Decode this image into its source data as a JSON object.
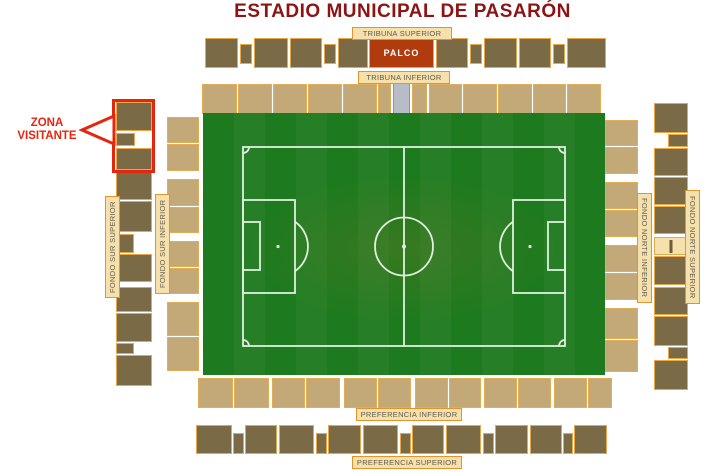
{
  "title": "ESTADIO MUNICIPAL DE PASARÓN",
  "callout": {
    "line1": "ZONA",
    "line2": "VISITANTE"
  },
  "labels": {
    "tribuna_superior": "TRIBUNA SUPERIOR",
    "tribuna_inferior": "TRIBUNA INFERIOR",
    "preferencia_inferior": "PREFERENCIA INFERIOR",
    "preferencia_superior": "PREFERENCIA SUPERIOR",
    "fondo_sur_superior": "FONDO SUR SUPERIOR",
    "fondo_sur_inferior": "FONDO SUR INFERIOR",
    "fondo_norte_inferior": "FONDO NORTE INFERIOR",
    "fondo_norte_superior": "FONDO NORTE SUPERIOR"
  },
  "colors": {
    "title": "#8d1414",
    "callout_red": "#e6250f",
    "dark_block": "#7a6a45",
    "block_border": "#eaa74a",
    "tan_block": "#c3a977",
    "tan_border": "#e3ad58",
    "label_bg": "#f6e0ac",
    "label_border": "#e2952d",
    "label_text": "#5f5b4e",
    "palco_bg": "#b03b0d",
    "palco_text": "#ffffff",
    "vip_gray": "#b7bcc7",
    "vip_gray_border": "#8a97ac",
    "pitch_green_a": "#1e7a1e",
    "pitch_green_b": "#267f26",
    "pitch_line": "#dff0df"
  },
  "stands": [
    {
      "name": "tribuna-superior",
      "kind": "dark",
      "blocks": [
        {
          "x": 205,
          "y": 38,
          "w": 33,
          "h": 30
        },
        {
          "x": 240,
          "y": 44,
          "w": 12,
          "h": 20
        },
        {
          "x": 254,
          "y": 38,
          "w": 34,
          "h": 30
        },
        {
          "x": 290,
          "y": 38,
          "w": 32,
          "h": 30
        },
        {
          "x": 324,
          "y": 44,
          "w": 12,
          "h": 20
        },
        {
          "x": 338,
          "y": 38,
          "w": 30,
          "h": 30
        },
        {
          "x": 369,
          "y": 38,
          "w": 65,
          "h": 30,
          "kind": "palco",
          "label": "PALCO"
        },
        {
          "x": 436,
          "y": 38,
          "w": 32,
          "h": 30
        },
        {
          "x": 470,
          "y": 44,
          "w": 12,
          "h": 20
        },
        {
          "x": 484,
          "y": 38,
          "w": 33,
          "h": 30
        },
        {
          "x": 519,
          "y": 38,
          "w": 32,
          "h": 30
        },
        {
          "x": 553,
          "y": 44,
          "w": 12,
          "h": 20
        },
        {
          "x": 567,
          "y": 38,
          "w": 39,
          "h": 30
        }
      ]
    },
    {
      "name": "tribuna-inferior",
      "kind": "tan",
      "blocks": [
        {
          "x": 202,
          "y": 84,
          "w": 35,
          "h": 30
        },
        {
          "x": 238,
          "y": 84,
          "w": 34,
          "h": 30
        },
        {
          "x": 273,
          "y": 84,
          "w": 34,
          "h": 30
        },
        {
          "x": 308,
          "y": 84,
          "w": 34,
          "h": 30
        },
        {
          "x": 343,
          "y": 84,
          "w": 34,
          "h": 30
        },
        {
          "x": 378,
          "y": 84,
          "w": 13,
          "h": 30
        },
        {
          "x": 393,
          "y": 83,
          "w": 17,
          "h": 31,
          "kind": "gray"
        },
        {
          "x": 412,
          "y": 84,
          "w": 15,
          "h": 30
        },
        {
          "x": 429,
          "y": 84,
          "w": 33,
          "h": 30
        },
        {
          "x": 463,
          "y": 84,
          "w": 34,
          "h": 30
        },
        {
          "x": 498,
          "y": 84,
          "w": 34,
          "h": 30
        },
        {
          "x": 533,
          "y": 84,
          "w": 33,
          "h": 30
        },
        {
          "x": 567,
          "y": 84,
          "w": 34,
          "h": 30
        }
      ]
    },
    {
      "name": "preferencia-inferior",
      "kind": "tan",
      "blocks": [
        {
          "x": 198,
          "y": 378,
          "w": 35,
          "h": 30
        },
        {
          "x": 234,
          "y": 378,
          "w": 35,
          "h": 30
        },
        {
          "x": 272,
          "y": 378,
          "w": 33,
          "h": 30
        },
        {
          "x": 306,
          "y": 378,
          "w": 34,
          "h": 30
        },
        {
          "x": 344,
          "y": 378,
          "w": 33,
          "h": 30
        },
        {
          "x": 378,
          "y": 378,
          "w": 33,
          "h": 30
        },
        {
          "x": 415,
          "y": 378,
          "w": 33,
          "h": 30
        },
        {
          "x": 449,
          "y": 378,
          "w": 32,
          "h": 30
        },
        {
          "x": 484,
          "y": 378,
          "w": 33,
          "h": 30
        },
        {
          "x": 518,
          "y": 378,
          "w": 33,
          "h": 30
        },
        {
          "x": 554,
          "y": 378,
          "w": 33,
          "h": 30
        },
        {
          "x": 588,
          "y": 378,
          "w": 24,
          "h": 30
        }
      ]
    },
    {
      "name": "preferencia-superior",
      "kind": "dark",
      "blocks": [
        {
          "x": 196,
          "y": 425,
          "w": 36,
          "h": 29
        },
        {
          "x": 233,
          "y": 433,
          "w": 11,
          "h": 21
        },
        {
          "x": 245,
          "y": 425,
          "w": 32,
          "h": 29
        },
        {
          "x": 279,
          "y": 425,
          "w": 35,
          "h": 29
        },
        {
          "x": 316,
          "y": 433,
          "w": 11,
          "h": 21
        },
        {
          "x": 328,
          "y": 425,
          "w": 33,
          "h": 29
        },
        {
          "x": 363,
          "y": 425,
          "w": 35,
          "h": 29
        },
        {
          "x": 400,
          "y": 433,
          "w": 11,
          "h": 21
        },
        {
          "x": 412,
          "y": 425,
          "w": 32,
          "h": 29
        },
        {
          "x": 446,
          "y": 425,
          "w": 35,
          "h": 29
        },
        {
          "x": 483,
          "y": 433,
          "w": 11,
          "h": 21
        },
        {
          "x": 495,
          "y": 425,
          "w": 33,
          "h": 29
        },
        {
          "x": 530,
          "y": 425,
          "w": 32,
          "h": 29
        },
        {
          "x": 563,
          "y": 433,
          "w": 10,
          "h": 21
        },
        {
          "x": 574,
          "y": 425,
          "w": 33,
          "h": 29
        }
      ]
    },
    {
      "name": "fondo-sur-superior",
      "kind": "dark",
      "blocks": [
        {
          "x": 116,
          "y": 102,
          "w": 36,
          "h": 29
        },
        {
          "x": 116,
          "y": 133,
          "w": 19,
          "h": 13
        },
        {
          "x": 116,
          "y": 148,
          "w": 36,
          "h": 22
        },
        {
          "x": 116,
          "y": 172,
          "w": 36,
          "h": 28
        },
        {
          "x": 116,
          "y": 201,
          "w": 36,
          "h": 31
        },
        {
          "x": 116,
          "y": 234,
          "w": 18,
          "h": 19
        },
        {
          "x": 116,
          "y": 254,
          "w": 36,
          "h": 28
        },
        {
          "x": 116,
          "y": 287,
          "w": 36,
          "h": 25
        },
        {
          "x": 116,
          "y": 313,
          "w": 36,
          "h": 29
        },
        {
          "x": 116,
          "y": 343,
          "w": 18,
          "h": 11
        },
        {
          "x": 116,
          "y": 355,
          "w": 36,
          "h": 31
        }
      ]
    },
    {
      "name": "fondo-sur-inferior",
      "kind": "tan",
      "blocks": [
        {
          "x": 167,
          "y": 117,
          "w": 32,
          "h": 26
        },
        {
          "x": 167,
          "y": 144,
          "w": 32,
          "h": 27
        },
        {
          "x": 167,
          "y": 179,
          "w": 32,
          "h": 27
        },
        {
          "x": 167,
          "y": 207,
          "w": 32,
          "h": 26
        },
        {
          "x": 167,
          "y": 241,
          "w": 32,
          "h": 26
        },
        {
          "x": 167,
          "y": 268,
          "w": 32,
          "h": 26
        },
        {
          "x": 167,
          "y": 302,
          "w": 32,
          "h": 34
        },
        {
          "x": 167,
          "y": 337,
          "w": 32,
          "h": 34
        }
      ]
    },
    {
      "name": "fondo-norte-inferior",
      "kind": "tan",
      "blocks": [
        {
          "x": 605,
          "y": 120,
          "w": 33,
          "h": 26
        },
        {
          "x": 605,
          "y": 147,
          "w": 33,
          "h": 27
        },
        {
          "x": 605,
          "y": 182,
          "w": 33,
          "h": 27
        },
        {
          "x": 605,
          "y": 210,
          "w": 33,
          "h": 27
        },
        {
          "x": 605,
          "y": 245,
          "w": 33,
          "h": 27
        },
        {
          "x": 605,
          "y": 273,
          "w": 33,
          "h": 27
        },
        {
          "x": 605,
          "y": 308,
          "w": 33,
          "h": 31
        },
        {
          "x": 605,
          "y": 340,
          "w": 33,
          "h": 32
        }
      ]
    },
    {
      "name": "fondo-norte-superior",
      "kind": "dark",
      "blocks": [
        {
          "x": 654,
          "y": 103,
          "w": 34,
          "h": 30
        },
        {
          "x": 668,
          "y": 134,
          "w": 20,
          "h": 13
        },
        {
          "x": 654,
          "y": 148,
          "w": 34,
          "h": 28
        },
        {
          "x": 654,
          "y": 177,
          "w": 34,
          "h": 28
        },
        {
          "x": 654,
          "y": 206,
          "w": 34,
          "h": 28
        },
        {
          "x": 654,
          "y": 237,
          "w": 34,
          "h": 18,
          "kind": "gate"
        },
        {
          "x": 654,
          "y": 256,
          "w": 34,
          "h": 29
        },
        {
          "x": 654,
          "y": 287,
          "w": 34,
          "h": 28
        },
        {
          "x": 654,
          "y": 316,
          "w": 34,
          "h": 30
        },
        {
          "x": 668,
          "y": 347,
          "w": 20,
          "h": 12
        },
        {
          "x": 654,
          "y": 360,
          "w": 34,
          "h": 30
        }
      ]
    }
  ]
}
